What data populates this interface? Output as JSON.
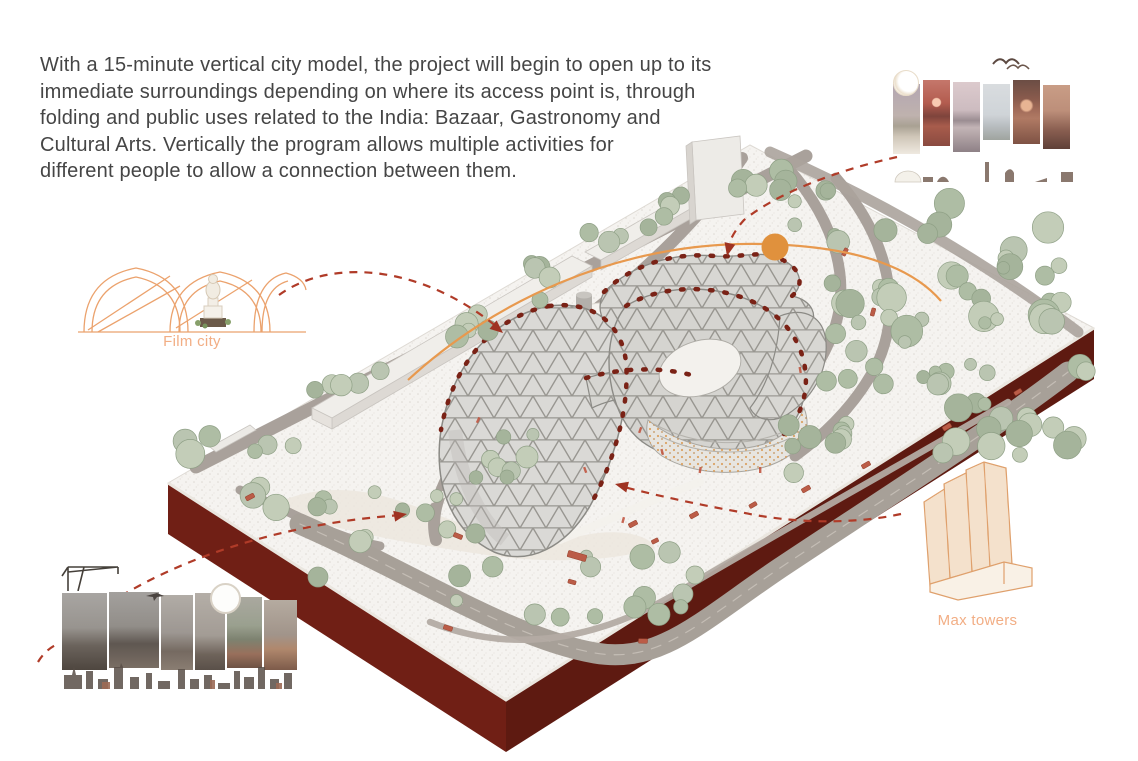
{
  "description": {
    "lines": [
      "With a 15-minute vertical city model, the project will begin to open up to its",
      "immediate surroundings depending on where its access point is, through",
      "folding and public uses related to the India: Bazaar, Gastronomy and",
      "Cultural Arts. Vertically the program allows multiple activities for",
      "different people to allow a connection between them."
    ]
  },
  "annotations": {
    "film_city": {
      "label": "Film city"
    },
    "max_towers": {
      "label": "Max towers"
    }
  },
  "icons": {
    "moon": "moon-icon",
    "sun": "sun-icon",
    "birds": "birds-icon",
    "crane": "crane-icon",
    "plane": "airplane-icon",
    "route_node": "route-node-dot"
  },
  "colors": {
    "accent_orange": "#e0913d",
    "route_line_orange": "#e8994e",
    "connector_red": "#b03b28",
    "base_maroon": "#701f15",
    "base_maroon_dark": "#5e1a11",
    "tree_green": "#b9c5b0",
    "pond_green": "#2e4e40",
    "road_gray": "#a7a098",
    "sketch_orange": "#eba26d",
    "label_orange": "#f2ae85",
    "text_gray": "#454545"
  }
}
